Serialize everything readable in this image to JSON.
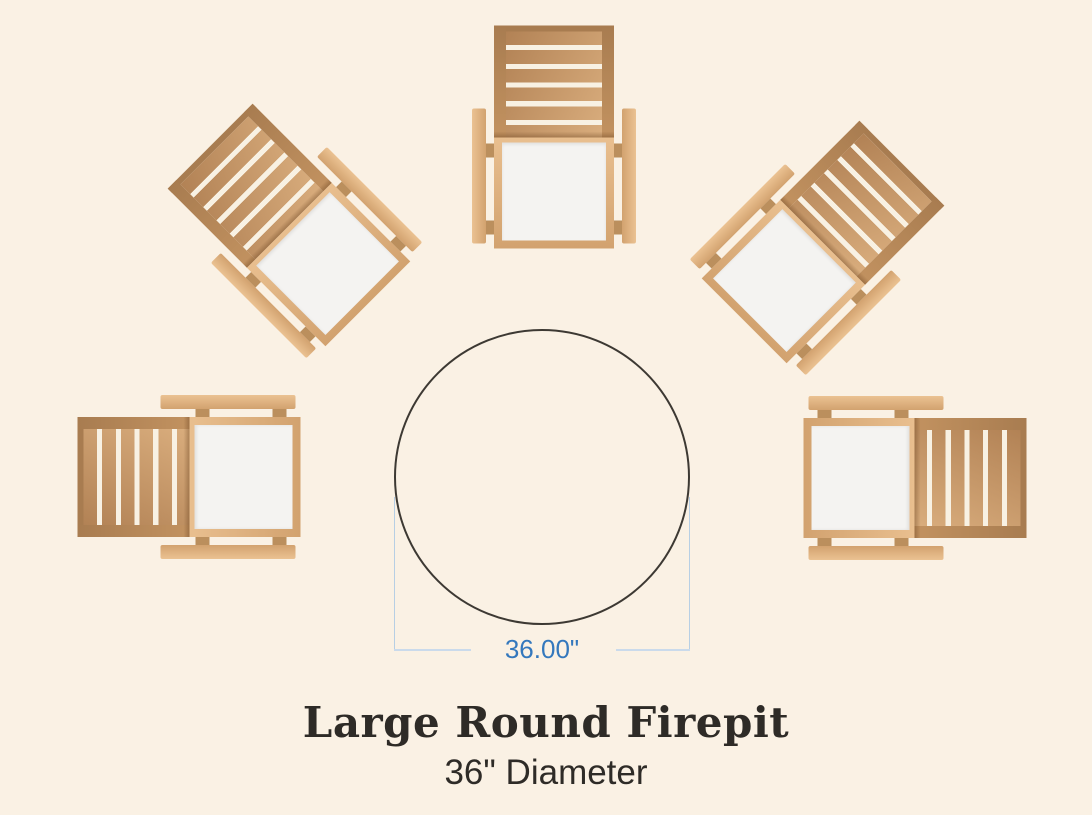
{
  "caption": {
    "title": "Large Round Firepit",
    "subtitle": "36\" Diameter"
  },
  "dimension": {
    "label": "36.00\"",
    "measured_feature": "firepit diameter"
  },
  "firepit": {
    "shape": "circle",
    "diameter_inches": 36
  },
  "chairs": {
    "count": 5,
    "items": [
      {
        "position": "top",
        "x": 554,
        "y": 137,
        "rotation": 0
      },
      {
        "position": "upper-left",
        "x": 289,
        "y": 225,
        "rotation": -45
      },
      {
        "position": "upper-right",
        "x": 823,
        "y": 242,
        "rotation": 45
      },
      {
        "position": "left",
        "x": 189,
        "y": 477,
        "rotation": -90
      },
      {
        "position": "right",
        "x": 915,
        "y": 478,
        "rotation": 90
      }
    ]
  },
  "colors": {
    "background": "#faf1e4",
    "text": "#2e2b27",
    "circle_stroke": "#3d3933",
    "dimension_text": "#3478bd",
    "dimension_line": "#cadaeb",
    "extension_line": "#b7cfe4",
    "wood_arm_light": "#ebc292",
    "wood_arm_dark": "#d2a26f",
    "wood_frame_light": "#e9bf8f",
    "wood_frame_dark": "#d2a26f",
    "wood_stile_dark": "#a87c50",
    "wood_stile_light": "#c29260",
    "wood_slat_dark": "#b28255",
    "wood_slat_light": "#d9ad7d",
    "slat_gap": "#f8f1e3",
    "connector": "#bb8f5d",
    "seat": "#f4f3f1"
  }
}
